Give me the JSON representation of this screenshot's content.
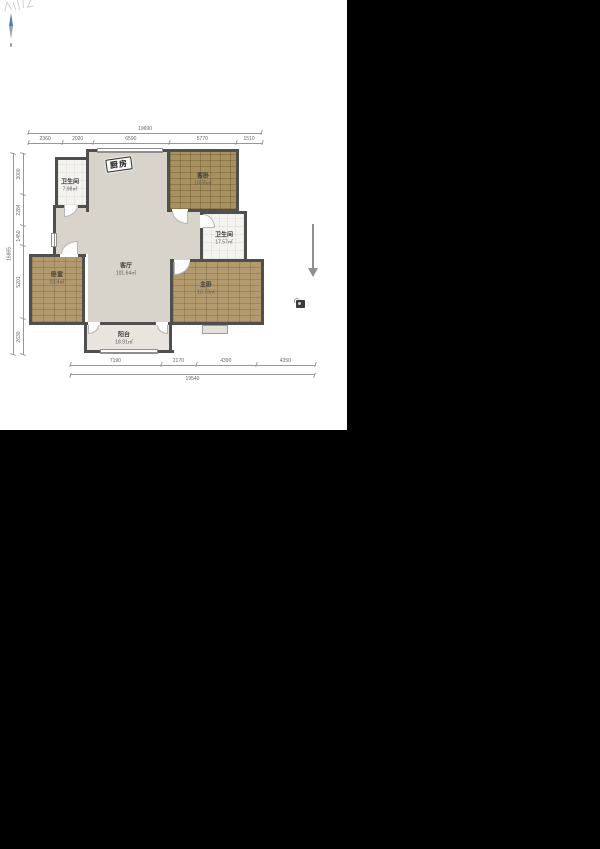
{
  "rooms": {
    "bath_top": {
      "name": "卫生间",
      "area": "7.98㎡"
    },
    "kitchen": {
      "name": "厨房"
    },
    "guest_bedroom": {
      "name": "客卧",
      "area": "10.55㎡"
    },
    "bath_right": {
      "name": "卫生间",
      "area": "17.57㎡"
    },
    "living": {
      "name": "客厅",
      "area": "101.64㎡"
    },
    "bedroom": {
      "name": "卧室",
      "area": "23.4㎡"
    },
    "master_bedroom": {
      "name": "主卧",
      "area": "13.73㎡"
    },
    "balcony": {
      "name": "阳台",
      "area": "18.91㎡"
    }
  },
  "dimensions": {
    "top": {
      "total": "19690",
      "segments": [
        "2360",
        "2020",
        "6590",
        "5770",
        "1510"
      ]
    },
    "bottom": {
      "total": "19540",
      "segments": [
        "7190",
        "2170",
        "4390",
        "4350"
      ]
    },
    "left": {
      "total": "16865",
      "segments": [
        "3000",
        "2284",
        "1450",
        "5201",
        "2630"
      ]
    }
  },
  "icons": {
    "compass": "compass-north-needle",
    "arrow": "down-direction-arrow",
    "marker": "small-marker-icon"
  },
  "colors": {
    "background": "#000000",
    "sheet": "#ffffff",
    "wall": "#4f4f4f",
    "living_floor": "#d9d4cb",
    "wood_floor": "#b29a6e",
    "guest_wood_floor": "#a8915f",
    "tile_floor": "#f4f3f0",
    "balcony_floor": "#e8e5df",
    "dimension_text": "#666666"
  },
  "watermark": {
    "text": ""
  }
}
